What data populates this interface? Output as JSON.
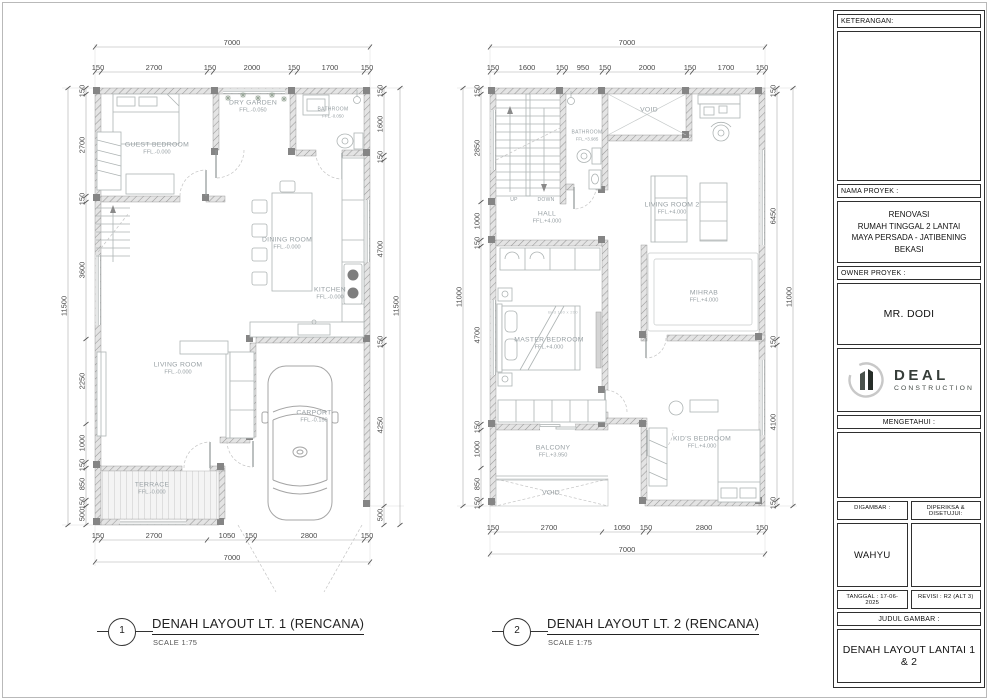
{
  "plans": [
    {
      "number": "1",
      "title": "DENAH LAYOUT LT. 1 (RENCANA)",
      "scale": "SCALE 1:75"
    },
    {
      "number": "2",
      "title": "DENAH LAYOUT LT. 2 (RENCANA)",
      "scale": "SCALE 1:75"
    }
  ],
  "title_block": {
    "keterangan_label": "KETERANGAN:",
    "nama_proyek_label": "NAMA PROYEK :",
    "nama_proyek_lines": [
      "RENOVASI",
      "RUMAH TINGGAL 2 LANTAI",
      "MAYA PERSADA - JATIBENING",
      "BEKASI"
    ],
    "owner_label": "OWNER PROYEK :",
    "owner_value": "MR. DODI",
    "logo_name": "DEAL",
    "logo_sub": "CONSTRUCTION",
    "mengetahui_label": "MENGETAHUI :",
    "digambar_label": "DIGAMBAR :",
    "diperiksa_label": "DIPERIKSA & DISETUJUI:",
    "digambar_value": "WAHYU",
    "tanggal_value": "TANGGAL : 17-06-2025",
    "revisi_value": "REVISI : R2 (ALT 3)",
    "judul_label": "JUDUL GAMBAR :",
    "judul_value": "DENAH LAYOUT LANTAI 1 & 2"
  },
  "room_labels": [
    {
      "x": 157,
      "y": 148,
      "name": "GUEST BEDROOM",
      "ffl": "FFL.-0.000"
    },
    {
      "x": 253,
      "y": 106,
      "name": "DRY GARDEN",
      "ffl": "FFL.-0.050"
    },
    {
      "x": 333,
      "y": 112,
      "name": "BATHROOM",
      "ffl": "FFL.-0.050",
      "cls": "small"
    },
    {
      "x": 287,
      "y": 243,
      "name": "DINING ROOM",
      "ffl": "FFL.-0.000"
    },
    {
      "x": 330,
      "y": 293,
      "name": "KITCHEN",
      "ffl": "FFL.-0.000"
    },
    {
      "x": 178,
      "y": 368,
      "name": "LIVING ROOM",
      "ffl": "FFL.-0.000"
    },
    {
      "x": 314,
      "y": 416,
      "name": "CARPORT",
      "ffl": "FFL.-0.150"
    },
    {
      "x": 152,
      "y": 488,
      "name": "TERRACE",
      "ffl": "FFL.-0.000"
    },
    {
      "x": 547,
      "y": 217,
      "name": "HALL",
      "ffl": "FFL.+4.000"
    },
    {
      "x": 587,
      "y": 135,
      "name": "BATHROOM",
      "ffl": "FFL.+3.985",
      "cls": "small"
    },
    {
      "x": 649,
      "y": 110,
      "name": "VOID"
    },
    {
      "x": 672,
      "y": 208,
      "name": "LIVING ROOM 2",
      "ffl": "FFL.+4.000"
    },
    {
      "x": 704,
      "y": 296,
      "name": "MIHRAB",
      "ffl": "FFL.+4.000"
    },
    {
      "x": 549,
      "y": 343,
      "name": "MASTER BEDROOM",
      "ffl": "FFL.+4.000"
    },
    {
      "x": 702,
      "y": 442,
      "name": "KID'S BEDROOM",
      "ffl": "FFL.+4.000"
    },
    {
      "x": 553,
      "y": 451,
      "name": "BALCONY",
      "ffl": "FFL.+3.950"
    },
    {
      "x": 551,
      "y": 493,
      "name": "VOID"
    },
    {
      "x": 514,
      "y": 200,
      "name": "UP",
      "cls": "small"
    },
    {
      "x": 546,
      "y": 200,
      "name": "DOWN",
      "cls": "small"
    },
    {
      "x": 563,
      "y": 312,
      "name": "Bed 180 x 200",
      "cls": "tiny"
    }
  ],
  "dim_labels": [
    {
      "x": 232,
      "y": 43,
      "v": "7000"
    },
    {
      "x": 98,
      "y": 68,
      "v": "150"
    },
    {
      "x": 154,
      "y": 68,
      "v": "2700"
    },
    {
      "x": 210,
      "y": 68,
      "v": "150"
    },
    {
      "x": 252,
      "y": 68,
      "v": "2000"
    },
    {
      "x": 294,
      "y": 68,
      "v": "150"
    },
    {
      "x": 330,
      "y": 68,
      "v": "1700"
    },
    {
      "x": 367,
      "y": 68,
      "v": "150"
    },
    {
      "x": 98,
      "y": 536,
      "v": "150"
    },
    {
      "x": 154,
      "y": 536,
      "v": "2700"
    },
    {
      "x": 227,
      "y": 536,
      "v": "1050"
    },
    {
      "x": 251,
      "y": 536,
      "v": "150"
    },
    {
      "x": 309,
      "y": 536,
      "v": "2800"
    },
    {
      "x": 367,
      "y": 536,
      "v": "150"
    },
    {
      "x": 232,
      "y": 558,
      "v": "7000"
    },
    {
      "x": 82,
      "y": 91,
      "v": "150",
      "r": 1
    },
    {
      "x": 82,
      "y": 145,
      "v": "2700",
      "r": 1
    },
    {
      "x": 82,
      "y": 199,
      "v": "150",
      "r": 1
    },
    {
      "x": 82,
      "y": 270,
      "v": "3600",
      "r": 1
    },
    {
      "x": 82,
      "y": 381,
      "v": "2250",
      "r": 1
    },
    {
      "x": 82,
      "y": 443,
      "v": "1000",
      "r": 1
    },
    {
      "x": 82,
      "y": 465,
      "v": "150",
      "r": 1
    },
    {
      "x": 82,
      "y": 484,
      "v": "850",
      "r": 1
    },
    {
      "x": 82,
      "y": 503,
      "v": "150",
      "r": 1
    },
    {
      "x": 82,
      "y": 515,
      "v": "500",
      "r": 1
    },
    {
      "x": 64,
      "y": 306,
      "v": "11500",
      "r": 1
    },
    {
      "x": 380,
      "y": 91,
      "v": "150",
      "r": 1
    },
    {
      "x": 380,
      "y": 124,
      "v": "1600",
      "r": 1
    },
    {
      "x": 380,
      "y": 157,
      "v": "150",
      "r": 1
    },
    {
      "x": 380,
      "y": 249,
      "v": "4700",
      "r": 1
    },
    {
      "x": 380,
      "y": 342,
      "v": "150",
      "r": 1
    },
    {
      "x": 380,
      "y": 425,
      "v": "4250",
      "r": 1
    },
    {
      "x": 380,
      "y": 515,
      "v": "500",
      "r": 1
    },
    {
      "x": 396,
      "y": 306,
      "v": "11500",
      "r": 1
    },
    {
      "x": 627,
      "y": 43,
      "v": "7000"
    },
    {
      "x": 493,
      "y": 68,
      "v": "150"
    },
    {
      "x": 527,
      "y": 68,
      "v": "1600"
    },
    {
      "x": 562,
      "y": 68,
      "v": "150"
    },
    {
      "x": 583,
      "y": 68,
      "v": "950"
    },
    {
      "x": 605,
      "y": 68,
      "v": "150"
    },
    {
      "x": 647,
      "y": 68,
      "v": "2000"
    },
    {
      "x": 690,
      "y": 68,
      "v": "150"
    },
    {
      "x": 726,
      "y": 68,
      "v": "1700"
    },
    {
      "x": 762,
      "y": 68,
      "v": "150"
    },
    {
      "x": 493,
      "y": 528,
      "v": "150"
    },
    {
      "x": 549,
      "y": 528,
      "v": "2700"
    },
    {
      "x": 622,
      "y": 528,
      "v": "1050"
    },
    {
      "x": 646,
      "y": 528,
      "v": "150"
    },
    {
      "x": 704,
      "y": 528,
      "v": "2800"
    },
    {
      "x": 762,
      "y": 528,
      "v": "150"
    },
    {
      "x": 627,
      "y": 550,
      "v": "7000"
    },
    {
      "x": 477,
      "y": 91,
      "v": "150",
      "r": 1
    },
    {
      "x": 477,
      "y": 148,
      "v": "2850",
      "r": 1
    },
    {
      "x": 477,
      "y": 221,
      "v": "1000",
      "r": 1
    },
    {
      "x": 477,
      "y": 243,
      "v": "150",
      "r": 1
    },
    {
      "x": 477,
      "y": 335,
      "v": "4700",
      "r": 1
    },
    {
      "x": 477,
      "y": 427,
      "v": "150",
      "r": 1
    },
    {
      "x": 477,
      "y": 449,
      "v": "1000",
      "r": 1
    },
    {
      "x": 477,
      "y": 484,
      "v": "850",
      "r": 1
    },
    {
      "x": 477,
      "y": 503,
      "v": "150",
      "r": 1
    },
    {
      "x": 459,
      "y": 297,
      "v": "11000",
      "r": 1
    },
    {
      "x": 773,
      "y": 91,
      "v": "150",
      "r": 1
    },
    {
      "x": 773,
      "y": 216,
      "v": "6450",
      "r": 1
    },
    {
      "x": 773,
      "y": 342,
      "v": "150",
      "r": 1
    },
    {
      "x": 773,
      "y": 422,
      "v": "4100",
      "r": 1
    },
    {
      "x": 773,
      "y": 503,
      "v": "150",
      "r": 1
    },
    {
      "x": 789,
      "y": 297,
      "v": "11000",
      "r": 1
    }
  ]
}
